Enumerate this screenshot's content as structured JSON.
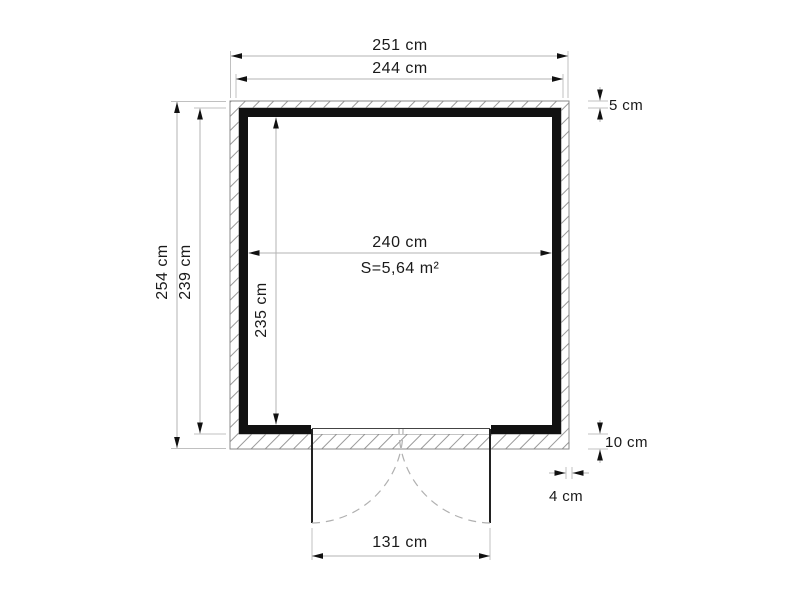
{
  "diagram": {
    "type": "floor-plan",
    "labels": {
      "outer_width": "251 cm",
      "frame_width": "244 cm",
      "top_band": "5 cm",
      "outer_depth": "254 cm",
      "inner_depth": "239 cm",
      "interior_width": "240 cm",
      "floor_area": "S=5,64 m²",
      "interior_depth": "235 cm",
      "bottom_band": "10 cm",
      "cladding_thickness": "4 cm",
      "door_width": "131 cm"
    },
    "colors": {
      "background": "#ffffff",
      "wall": "#111111",
      "hatch": "#999999",
      "band_outline": "#888888",
      "dimension_line": "#b3b3b3",
      "arrowhead": "#111111",
      "text": "#1a1a1a",
      "door_swing": "#b0b0b0"
    }
  }
}
